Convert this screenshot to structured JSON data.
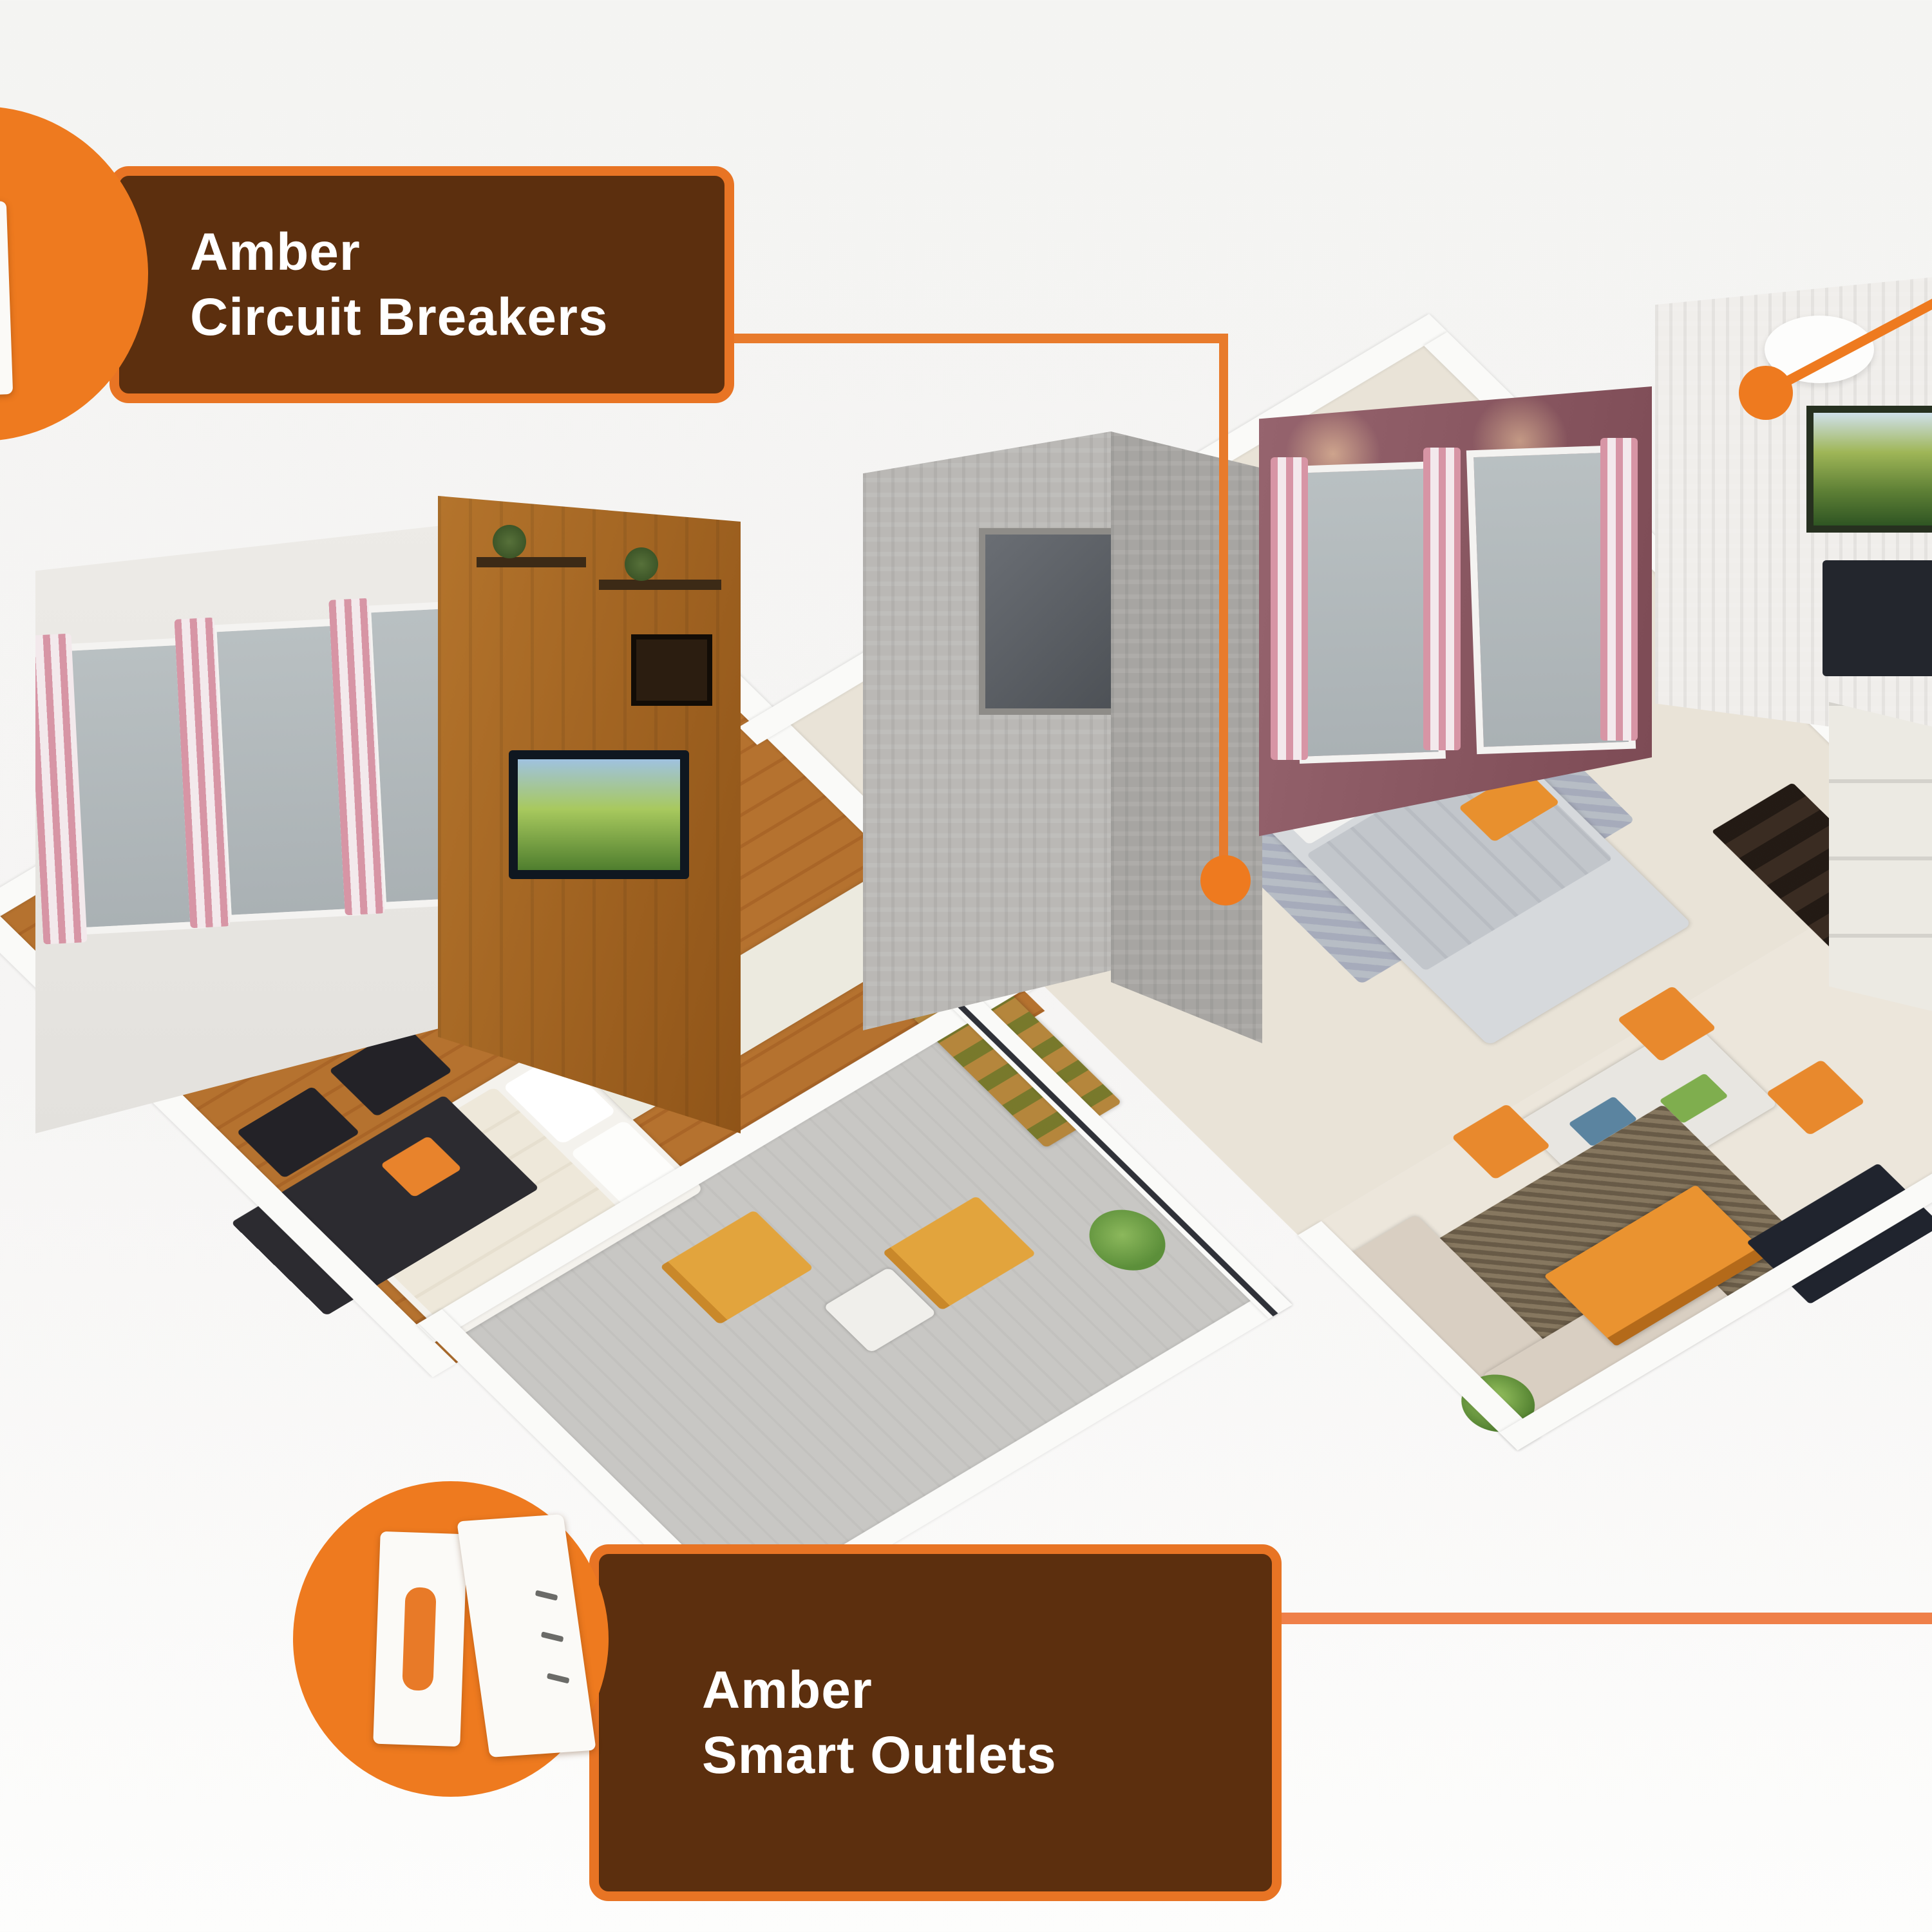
{
  "scene": {
    "background": "#f5f4f2",
    "subject": "isometric-apartment-floor-plan"
  },
  "colors": {
    "accent_orange": "#ee7a1f",
    "callout_box_bg": "#5c2f0e",
    "callout_border": "#e87424",
    "callout_text": "#ffffff",
    "connector_orange": "#e87b2c",
    "connector_salmon": "#ef8049",
    "wood_floor": "#b5722f",
    "wood_wall": "#a96a25",
    "mauve_wall": "#8d5a64",
    "tile_wall": "#b9b7b4",
    "curtain_pink": "#d795a5"
  },
  "callouts": {
    "circuit_breakers": {
      "line1": "Amber",
      "line2": "Circuit Breakers",
      "icon": "circuit-breaker-panel-icon"
    },
    "smart_outlets": {
      "line1": "Amber",
      "line2": "Smart Outlets",
      "icon": "smart-outlet-icon"
    }
  }
}
